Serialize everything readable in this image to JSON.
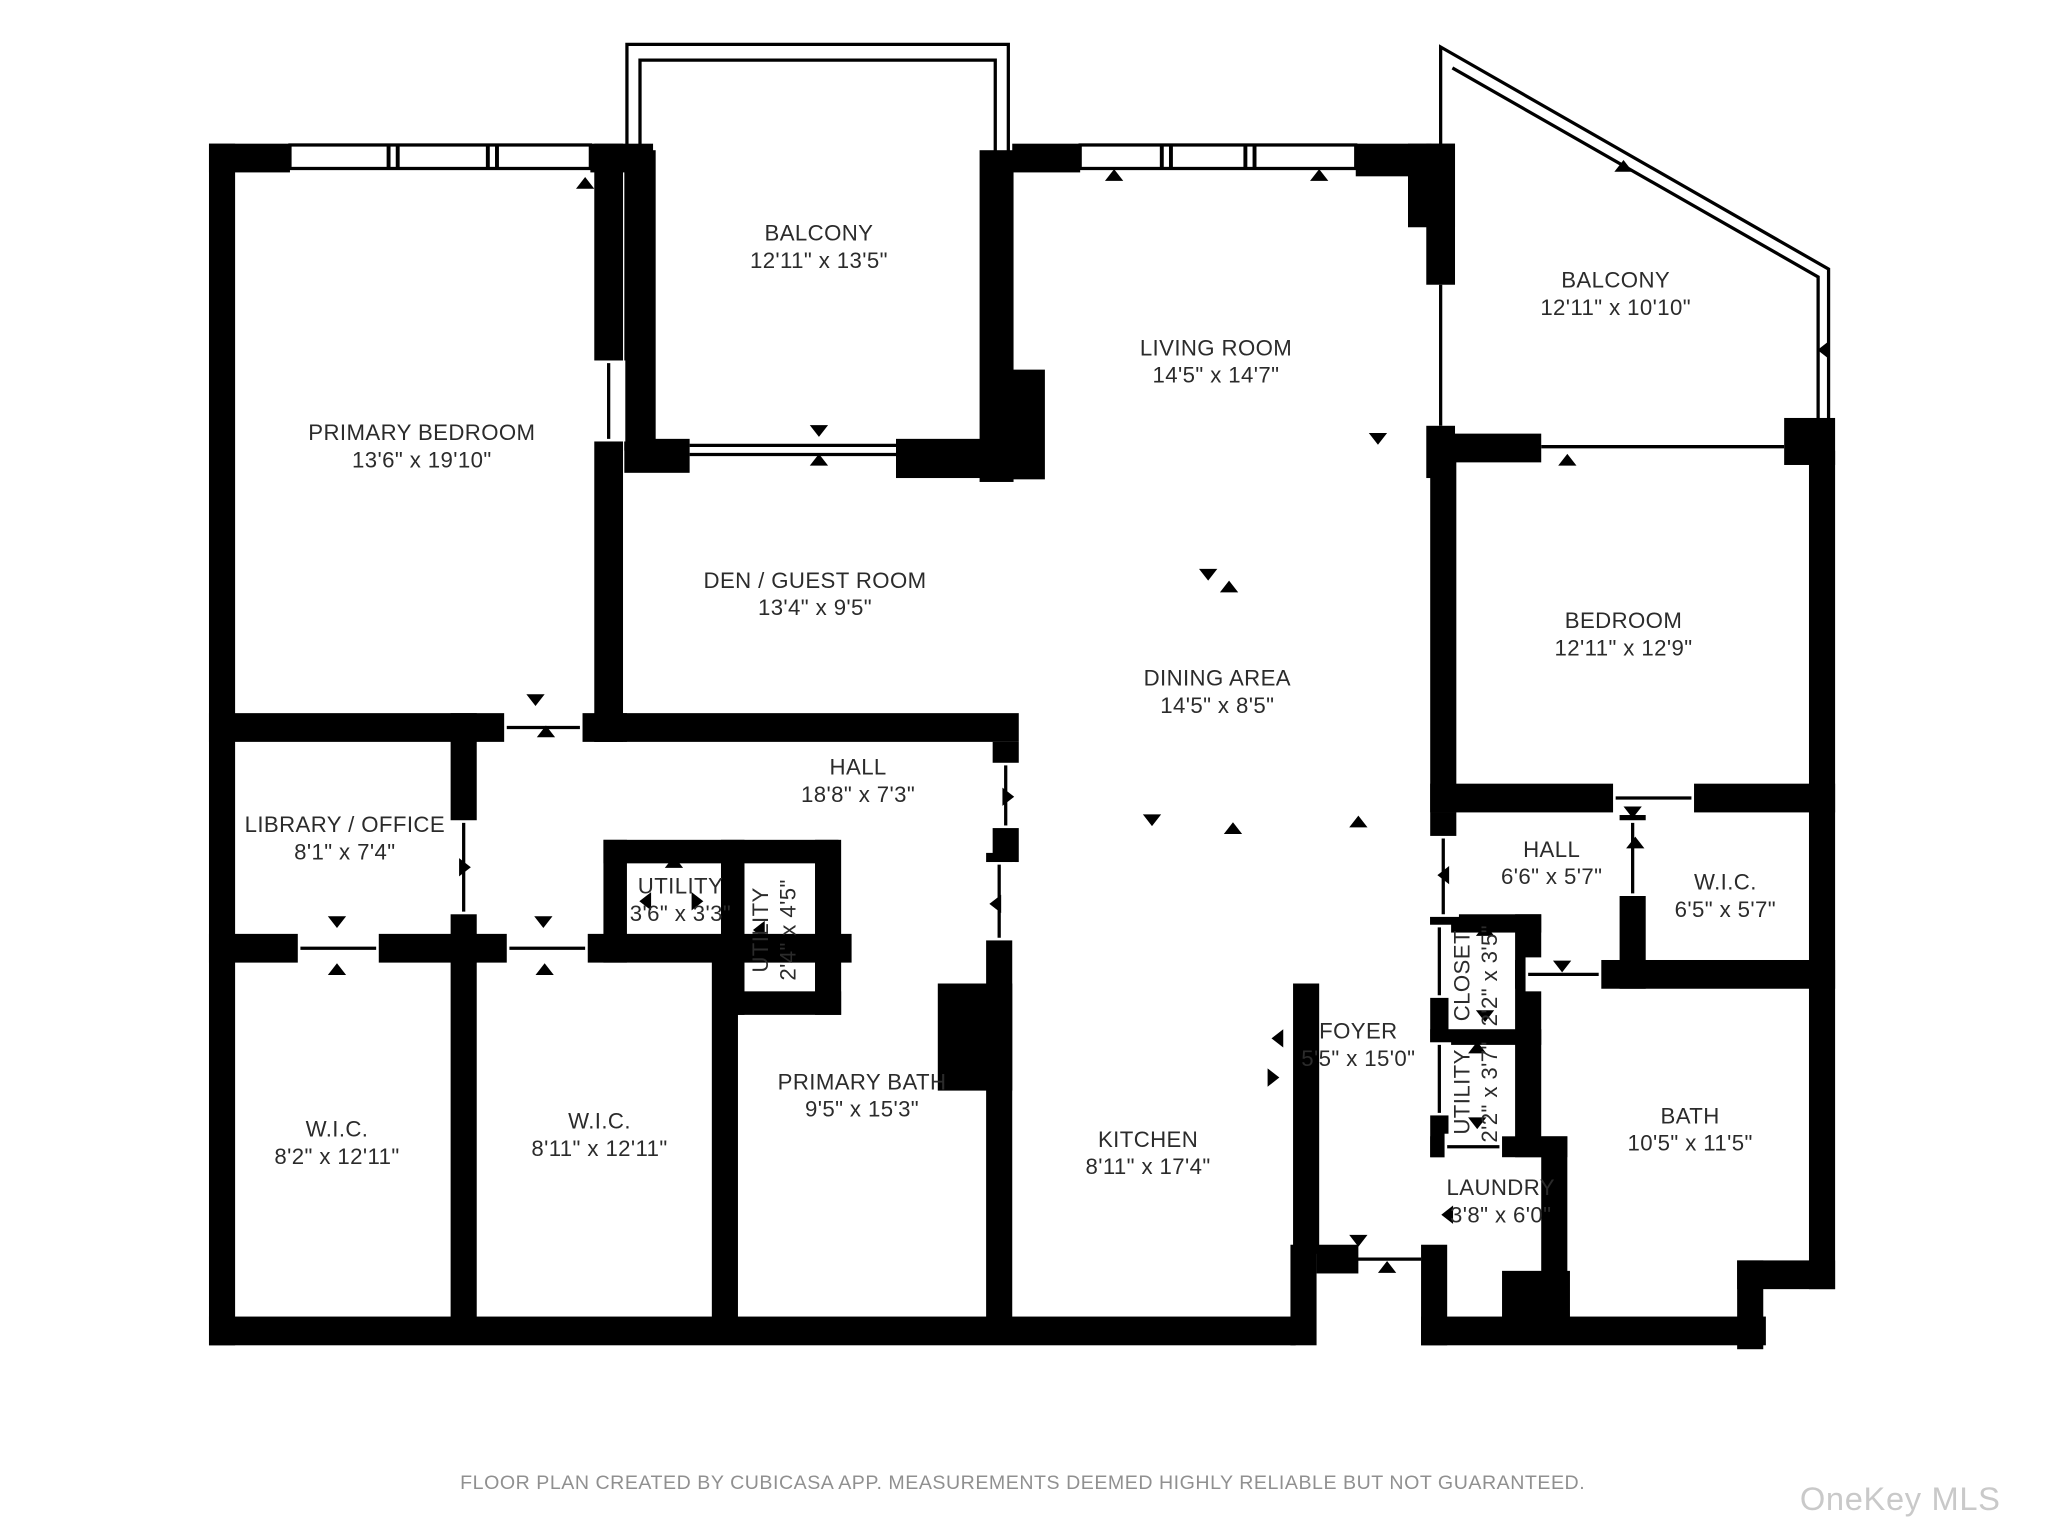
{
  "floor_plan": {
    "rooms": [
      {
        "name": "PRIMARY BEDROOM",
        "dims": "13'6\" x 19'10\""
      },
      {
        "name": "BALCONY",
        "dims": "12'11\" x 13'5\""
      },
      {
        "name": "LIVING ROOM",
        "dims": "14'5\" x 14'7\""
      },
      {
        "name": "BALCONY",
        "dims": "12'11\" x 10'10\""
      },
      {
        "name": "DEN / GUEST ROOM",
        "dims": "13'4\" x 9'5\""
      },
      {
        "name": "DINING AREA",
        "dims": "14'5\" x 8'5\""
      },
      {
        "name": "BEDROOM",
        "dims": "12'11\" x 12'9\""
      },
      {
        "name": "HALL",
        "dims": "18'8\" x 7'3\""
      },
      {
        "name": "LIBRARY / OFFICE",
        "dims": "8'1\" x 7'4\""
      },
      {
        "name": "UTILITY",
        "dims": "3'6\" x 3'3\""
      },
      {
        "name": "UTILITY",
        "dims": "2'4\" x 4'5\""
      },
      {
        "name": "W.I.C.",
        "dims": "8'2\" x 12'11\""
      },
      {
        "name": "W.I.C.",
        "dims": "8'11\" x 12'11\""
      },
      {
        "name": "PRIMARY BATH",
        "dims": "9'5\" x 15'3\""
      },
      {
        "name": "KITCHEN",
        "dims": "8'11\" x 17'4\""
      },
      {
        "name": "FOYER",
        "dims": "5'5\" x 15'0\""
      },
      {
        "name": "HALL",
        "dims": "6'6\" x 5'7\""
      },
      {
        "name": "W.I.C.",
        "dims": "6'5\" x 5'7\""
      },
      {
        "name": "CLOSET",
        "dims": "2'2\" x 3'5\""
      },
      {
        "name": "UTILITY",
        "dims": "2'2\" x 3'7\""
      },
      {
        "name": "LAUNDRY",
        "dims": "3'8\" x 6'0\""
      },
      {
        "name": "BATH",
        "dims": "10'5\" x 11'5\""
      }
    ],
    "footer": "FLOOR PLAN CREATED BY CUBICASA APP. MEASUREMENTS DEEMED HIGHLY RELIABLE BUT NOT GUARANTEED.",
    "watermark": "OneKey MLS",
    "colors": {
      "wall": "#000000",
      "background": "#ffffff",
      "label_text": "#2b2b2b",
      "footer_text": "#909090",
      "watermark_text": "#c9c9c9"
    }
  }
}
